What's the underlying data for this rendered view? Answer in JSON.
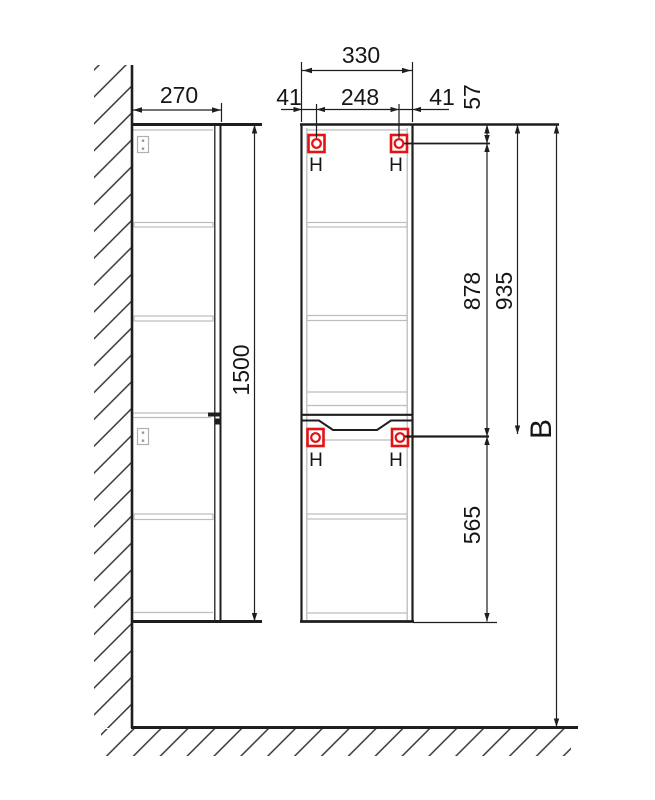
{
  "colors": {
    "accent": "#e21313",
    "line": "#1e1e1e",
    "muted": "#bcbcbc"
  },
  "dimensions": {
    "side_depth": "270",
    "height": "1500",
    "front_width": "330",
    "hole_offset_left": "41",
    "hole_spacing": "248",
    "hole_offset_right": "41",
    "top_to_hole": "57",
    "upper_to_mid_hole": "878",
    "top_to_mid_hole": "935",
    "mid_hole_to_bottom": "565",
    "overall_height": "B"
  },
  "mount_point": {
    "label": "H"
  }
}
